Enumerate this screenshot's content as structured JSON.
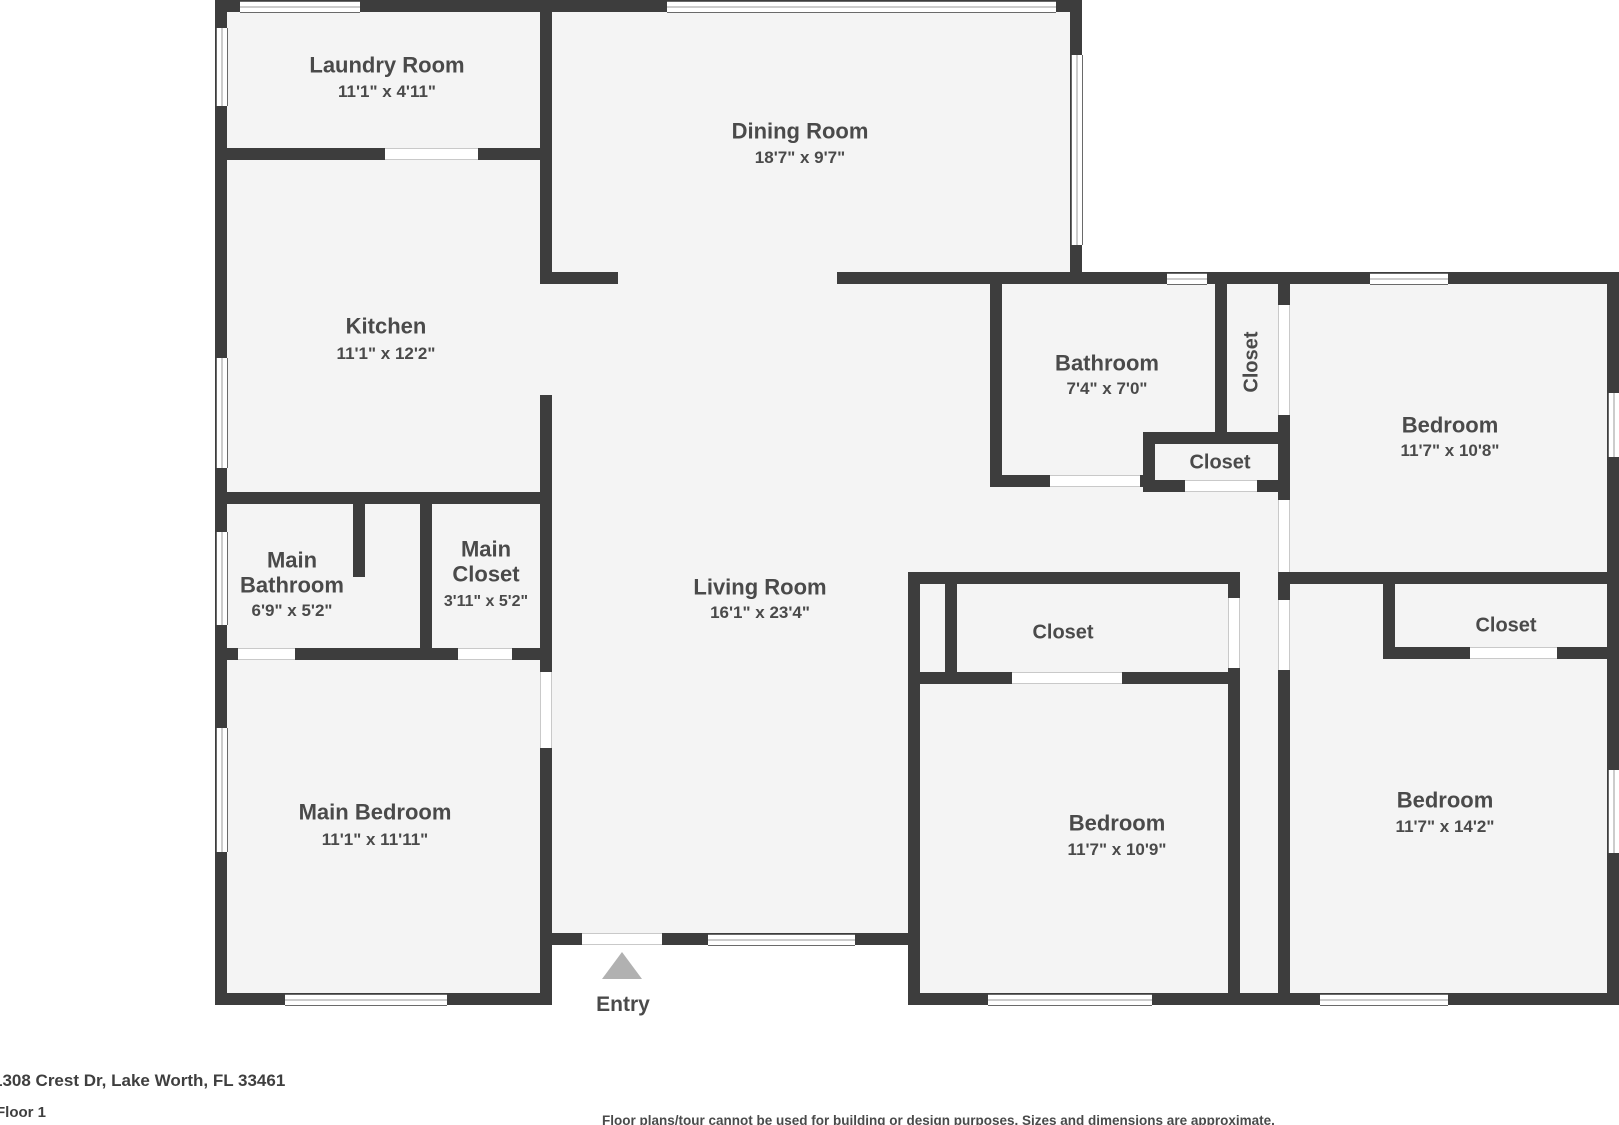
{
  "plan": {
    "rooms": [
      {
        "id": "laundry",
        "name": "Laundry Room",
        "dims": "11'1\" x 4'11\""
      },
      {
        "id": "dining",
        "name": "Dining Room",
        "dims": "18'7\" x 9'7\""
      },
      {
        "id": "kitchen",
        "name": "Kitchen",
        "dims": "11'1\" x 12'2\""
      },
      {
        "id": "bathroom",
        "name": "Bathroom",
        "dims": "7'4\" x 7'0\""
      },
      {
        "id": "bedroom-top-right",
        "name": "Bedroom",
        "dims": "11'7\" x 10'8\""
      },
      {
        "id": "main-bathroom",
        "name": "Main Bathroom",
        "dims": "6'9\" x 5'2\""
      },
      {
        "id": "main-closet",
        "name": "Main Closet",
        "dims": "3'11\" x 5'2\""
      },
      {
        "id": "living-room",
        "name": "Living Room",
        "dims": "16'1\" x 23'4\""
      },
      {
        "id": "main-bedroom",
        "name": "Main Bedroom",
        "dims": "11'1\" x 11'11\""
      },
      {
        "id": "bedroom-middle",
        "name": "Bedroom",
        "dims": "11'7\" x 10'9\""
      },
      {
        "id": "bedroom-bottom-right",
        "name": "Bedroom",
        "dims": "11'7\" x 14'2\""
      }
    ],
    "closets": [
      "Closet",
      "Closet",
      "Closet",
      "Closet"
    ],
    "entry_label": "Entry"
  },
  "footer": {
    "address": "1308 Crest Dr, Lake Worth, FL 33461",
    "floor": "Floor 1",
    "disclaimer": "Floor plans/tour cannot be used for building or design purposes. Sizes and dimensions are approximate."
  },
  "colors": {
    "wall": "#3d3d3d",
    "room_fill": "#f4f4f4",
    "entry_arrow": "#b1b1b1",
    "label_text": "#4a4a4a"
  }
}
